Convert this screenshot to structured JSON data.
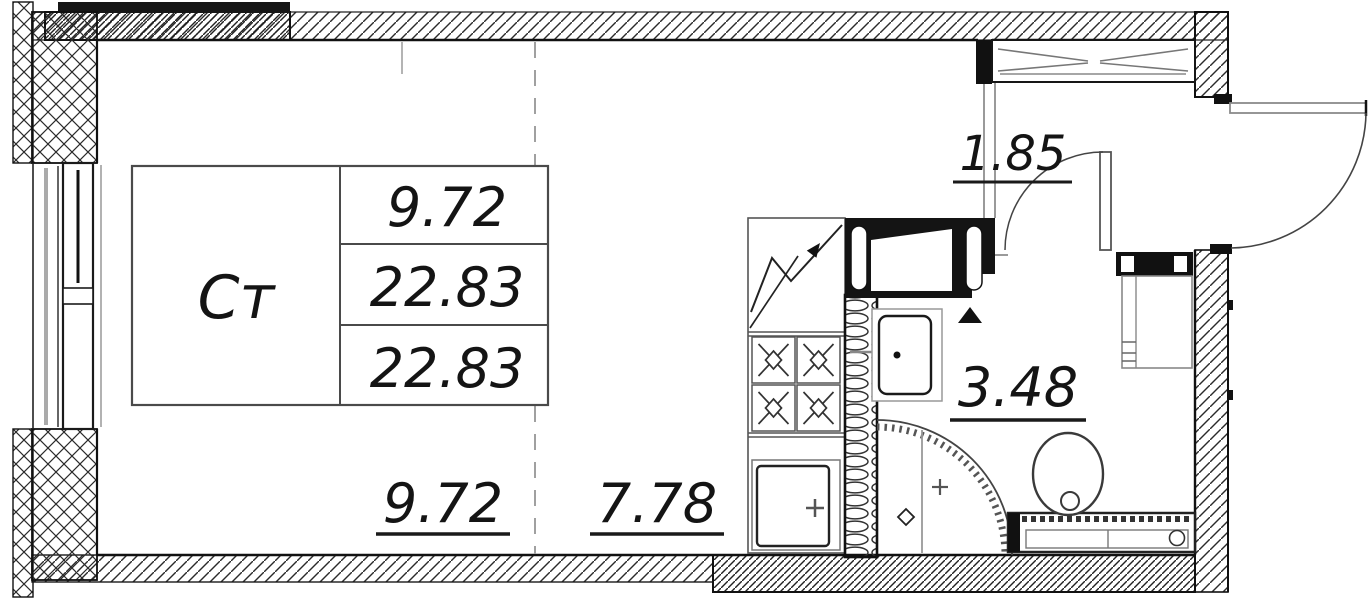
{
  "plan": {
    "table": {
      "room_label": "Ст",
      "rows": [
        "9.72",
        "22.83",
        "22.83"
      ]
    },
    "dimensions": {
      "living": "9.72",
      "kitchen": "7.78",
      "hall": "1.85",
      "bath": "3.48"
    },
    "colors": {
      "ink": "#1a1a1a",
      "line_gray": "#999999",
      "background": "#ffffff"
    }
  }
}
